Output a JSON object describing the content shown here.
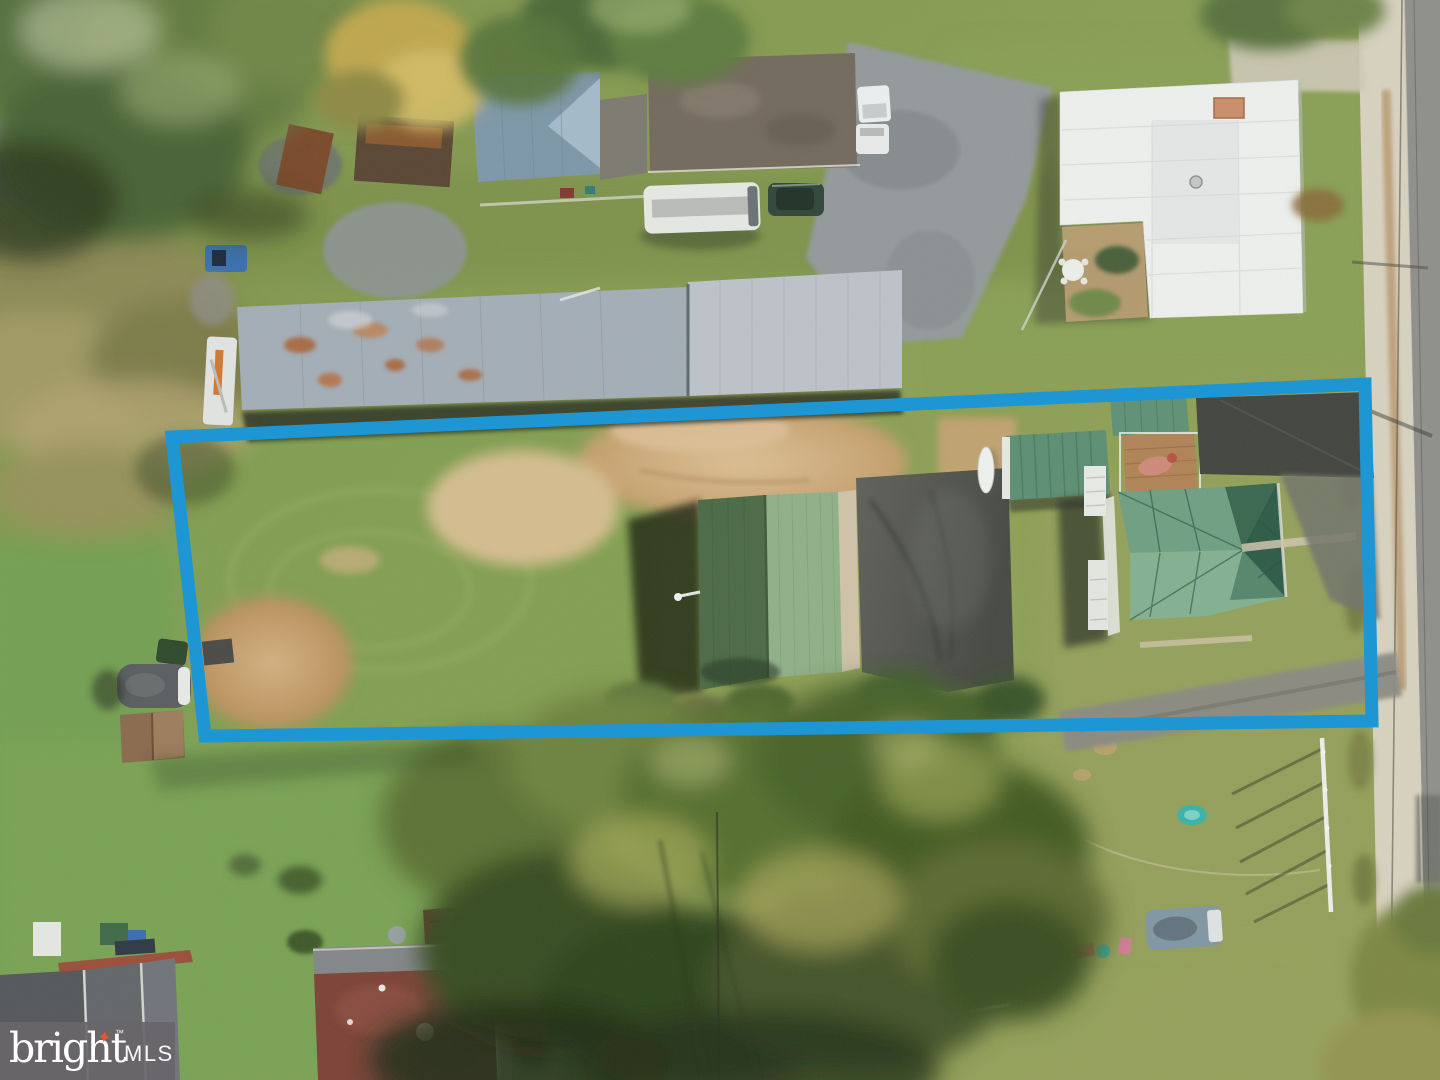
{
  "photo": {
    "kind": "aerial-drone-real-estate-photo",
    "subject": "Overhead drone view of a long narrow grass-and-dirt lot outlined in blue, containing a green metal-roof garage and a green hip-roof house with rooftop deck, bordered by gray barns and a mobile home above, neighboring homes and sheds below, large trees, and a street with concrete gutter along the right edge"
  },
  "overlay": {
    "boundary_color": "#1e96d3"
  },
  "watermark": {
    "brand": "bright",
    "suffix": "MLS",
    "trademark": "™",
    "sparkle_glyph": "✦",
    "bg_color": "rgba(104,102,105,0.93)",
    "text_color": "#ffffff",
    "accent_color": "#e8562e"
  },
  "palette": {
    "grass_base": "#87a156",
    "lawn_green": "#74a052",
    "olive_lawn": "#95a05b",
    "dirt": "#cfae7f",
    "dirt_light": "#d9bf93",
    "gravel": "#949a9b",
    "road": "#8f908c",
    "concrete": "#d8d2c0",
    "asphalt_dark": "#43463f",
    "asphalt_pad": "#55584f",
    "drive_gray": "#8b8b82",
    "barn_left": "#a4aeb6",
    "barn_right": "#bcc3c9",
    "rust": "#a96134",
    "white_roof": "#eef0ee",
    "chimney_brick": "#c98f6a",
    "mobile_blue": "#7e98a9",
    "mobile_brown": "#746a5e",
    "garage_dark": "#4d6b47",
    "garage_light": "#8fb189",
    "container_green": "#5d8f74",
    "wing_green": "#5f9176",
    "deck_wood": "#b08457",
    "house_green_light": "#6fa083",
    "house_green_dark": "#2e5c48",
    "house_green_mid": "#84b192",
    "house_green_deep": "#3a6850",
    "red_roof": "#7d4338",
    "shed_brown": "#7b4b33",
    "shed_gray": "#777b7a",
    "camper_gray": "#5a5e60",
    "lower_deck": "#5f3a2e",
    "trailer_gray": "#98a0a5",
    "car_red": "#a23527",
    "truck_blue": "#6f95bb",
    "suv_green": "#31473a",
    "rv_white": "#e6e8e4",
    "boom_truck_white": "#e2e4e1",
    "skid_blue": "#3a6fae",
    "pool_teal": "#3cb3a8",
    "fence_white": "#e9ebe7",
    "shadow_dark": "#242b1b"
  }
}
